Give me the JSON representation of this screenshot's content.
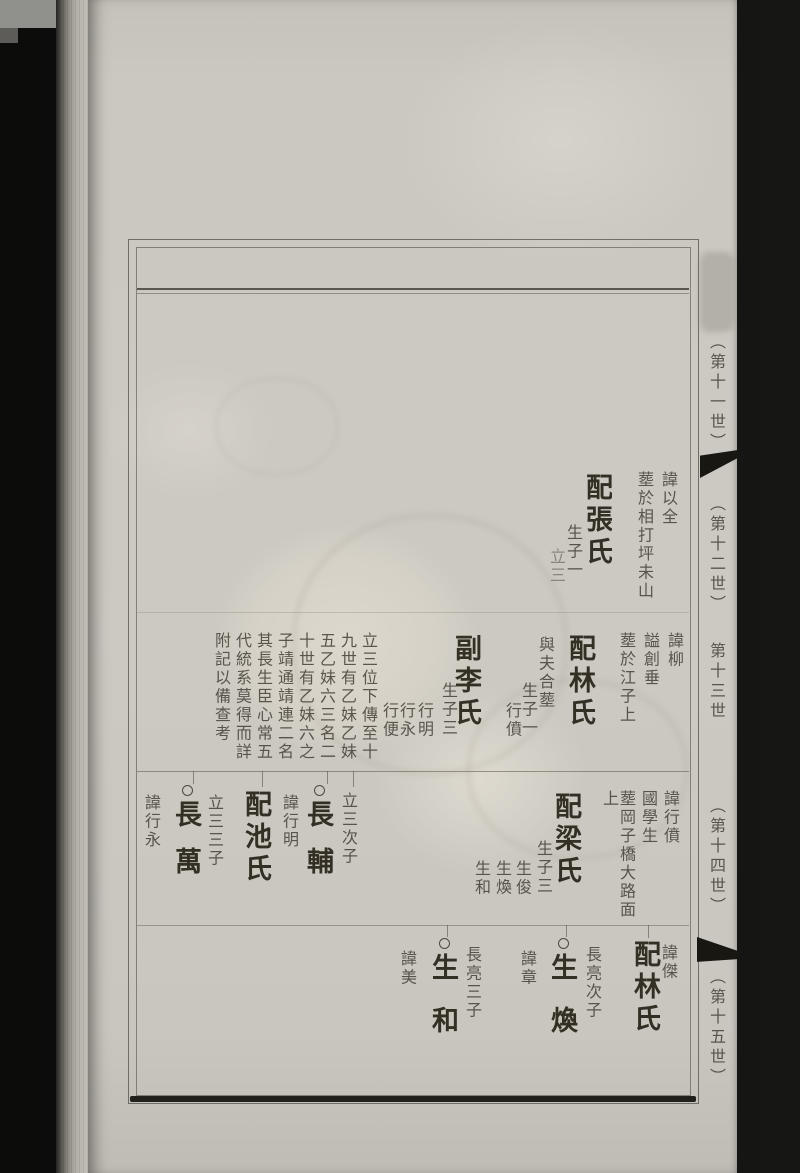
{
  "document": {
    "kind": "genealogy-book-scan",
    "ink_color": "#272318",
    "paper_color": "#ccc9c2",
    "margin_labels": [
      {
        "text": "（第十一世）",
        "y": 333
      },
      {
        "text": "（第十二世）",
        "y": 495
      },
      {
        "text": "第十三世",
        "y": 642
      },
      {
        "text": "（第十四世）",
        "y": 797
      },
      {
        "text": "（第十五世）",
        "y": 968
      }
    ],
    "columns": [
      {
        "text": "諱以全",
        "x": 660,
        "y": 471,
        "size": "sm"
      },
      {
        "text": "塟於相打坪未山",
        "x": 636,
        "y": 471,
        "size": "sm"
      },
      {
        "text": "配張氏",
        "x": 583,
        "y": 473,
        "size": "lg"
      },
      {
        "text": "生子一",
        "x": 565,
        "y": 524,
        "size": "sm"
      },
      {
        "text": "立三",
        "x": 548,
        "y": 548,
        "size": "sm",
        "faded": true
      },
      {
        "text": "諱柳",
        "x": 666,
        "y": 632,
        "size": "sm"
      },
      {
        "text": "謚創垂",
        "x": 642,
        "y": 632,
        "size": "sm"
      },
      {
        "text": "塟於江子上",
        "x": 618,
        "y": 632,
        "size": "sm"
      },
      {
        "text": "配林氏",
        "x": 566,
        "y": 634,
        "size": "lg"
      },
      {
        "text": "與夫合塟",
        "x": 537,
        "y": 636,
        "size": "sm"
      },
      {
        "text": "生子一",
        "x": 520,
        "y": 682,
        "size": "sm"
      },
      {
        "text": "行僨",
        "x": 504,
        "y": 702,
        "size": "sm"
      },
      {
        "text": "副李氏",
        "x": 452,
        "y": 634,
        "size": "lg"
      },
      {
        "text": "生子三",
        "x": 440,
        "y": 682,
        "size": "sm"
      },
      {
        "text": "行明",
        "x": 416,
        "y": 702,
        "size": "sm"
      },
      {
        "text": "行永",
        "x": 398,
        "y": 702,
        "size": "sm"
      },
      {
        "text": "行便",
        "x": 381,
        "y": 702,
        "size": "sm"
      },
      {
        "text": "立三位下傳至十",
        "x": 360,
        "y": 632,
        "size": "sm"
      },
      {
        "text": "九世有乙妹乙妹",
        "x": 339,
        "y": 632,
        "size": "sm"
      },
      {
        "text": "五乙妹六三名二",
        "x": 318,
        "y": 632,
        "size": "sm"
      },
      {
        "text": "十世有乙妹六之",
        "x": 297,
        "y": 632,
        "size": "sm"
      },
      {
        "text": "子靖通靖連二名",
        "x": 276,
        "y": 632,
        "size": "sm"
      },
      {
        "text": "其長生臣心常五",
        "x": 255,
        "y": 632,
        "size": "sm"
      },
      {
        "text": "代統系莫得而詳",
        "x": 234,
        "y": 632,
        "size": "sm"
      },
      {
        "text": "附記以備查考",
        "x": 213,
        "y": 632,
        "size": "sm"
      },
      {
        "text": "諱行僨",
        "x": 662,
        "y": 790,
        "size": "sm"
      },
      {
        "text": "國學生",
        "x": 640,
        "y": 790,
        "size": "sm"
      },
      {
        "text": "塟岡子橋大路面",
        "x": 618,
        "y": 790,
        "size": "sm"
      },
      {
        "text": "上",
        "x": 601,
        "y": 790,
        "size": "sm"
      },
      {
        "text": "配梁氏",
        "x": 552,
        "y": 792,
        "size": "lg"
      },
      {
        "text": "生子三",
        "x": 535,
        "y": 840,
        "size": "sm"
      },
      {
        "text": "生俊",
        "x": 514,
        "y": 860,
        "size": "sm"
      },
      {
        "text": "生煥",
        "x": 494,
        "y": 860,
        "size": "sm"
      },
      {
        "text": "生和",
        "x": 473,
        "y": 860,
        "size": "sm"
      },
      {
        "text": "立三次子",
        "x": 340,
        "y": 792,
        "size": "sm"
      },
      {
        "text": "長輔",
        "x": 304,
        "y": 785,
        "size": "lg",
        "circle": true,
        "ls": 20
      },
      {
        "text": "諱行明",
        "x": 281,
        "y": 794,
        "size": "sm"
      },
      {
        "text": "配池氏",
        "x": 242,
        "y": 790,
        "size": "lg"
      },
      {
        "text": "立三三子",
        "x": 206,
        "y": 794,
        "size": "sm"
      },
      {
        "text": "長萬",
        "x": 172,
        "y": 785,
        "size": "lg",
        "circle": true,
        "ls": 20
      },
      {
        "text": "諱行永",
        "x": 143,
        "y": 794,
        "size": "sm"
      },
      {
        "text": "諱傑",
        "x": 660,
        "y": 944,
        "size": "sm"
      },
      {
        "text": "配林氏",
        "x": 631,
        "y": 940,
        "size": "lg"
      },
      {
        "text": "長亮次子",
        "x": 584,
        "y": 946,
        "size": "sm"
      },
      {
        "text": "生煥",
        "x": 548,
        "y": 938,
        "size": "lg",
        "circle": true,
        "ls": 26
      },
      {
        "text": "諱章",
        "x": 519,
        "y": 950,
        "size": "sm"
      },
      {
        "text": "長亮三子",
        "x": 464,
        "y": 946,
        "size": "sm"
      },
      {
        "text": "生和",
        "x": 429,
        "y": 938,
        "size": "lg",
        "circle": true,
        "ls": 26
      },
      {
        "text": "諱美",
        "x": 399,
        "y": 950,
        "size": "sm"
      }
    ]
  }
}
